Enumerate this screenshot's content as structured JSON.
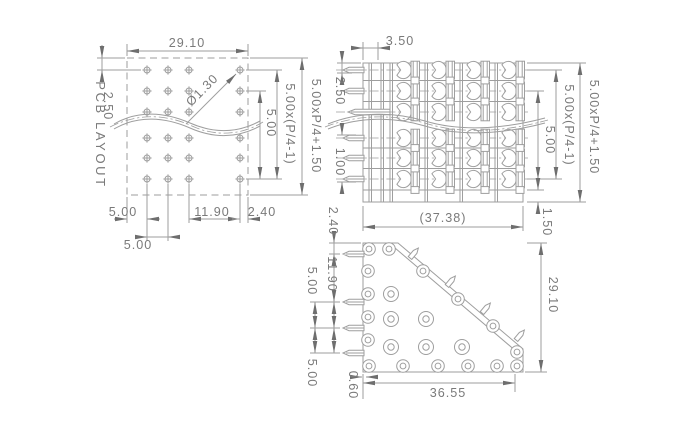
{
  "style": {
    "background": "#ffffff",
    "line_color": "#9e9e9e",
    "text_color": "#7a7a7a",
    "arrow_color": "#6e6e6e"
  },
  "views": {
    "pcb": {
      "title": "PCB LAYOUT",
      "grid": {
        "rows": 6,
        "cols": 4,
        "hole_symbol": "crosshair-drill"
      },
      "dims": {
        "width": "29.10",
        "top_margin": "2.50",
        "hole_dia": "Ø1.30",
        "row_pitch": "5.00",
        "row_span": "5.00x(P/4-1)",
        "overall_height": "5.00xP/4+1.50",
        "left_margin": "5.00",
        "col_pitch": "5.00",
        "col_gap": "11.90",
        "right_margin": "2.40"
      }
    },
    "front": {
      "grid": {
        "rows": 6,
        "cols": 4
      },
      "dims": {
        "wall_thickness": "3.50",
        "top_to_pin": "2.50",
        "pin_offset": "1.00",
        "row_pitch": "5.00",
        "row_span": "5.00x(P/4-1)",
        "overall_height": "5.00xP/4+1.50",
        "bottom_margin": "1.50",
        "overall_width": "(37.38)"
      }
    },
    "top": {
      "screw_heads": 6,
      "dims": {
        "edge_to_pin": "2.40",
        "pin_gap_large": "11.90",
        "pin_pitch_a": "5.00",
        "pin_pitch_b": "5.00",
        "corner_offset": "0.60",
        "body_width": "36.55",
        "body_depth": "29.10"
      }
    }
  }
}
